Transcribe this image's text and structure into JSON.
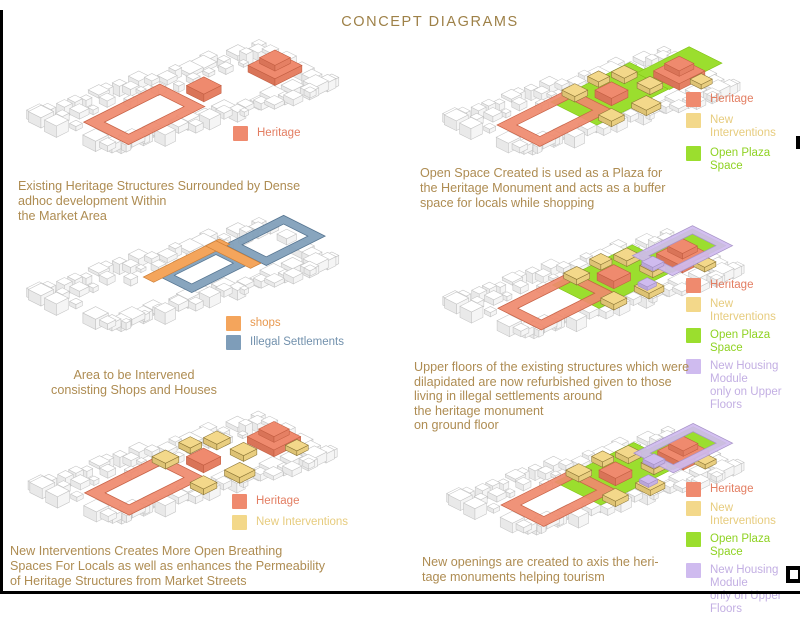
{
  "title": "CONCEPT DIAGRAMS",
  "colors": {
    "heritage": "#EF8A6E",
    "new_interventions": "#F3D88A",
    "open_plaza_space": "#9BDE2E",
    "new_housing_module": "#CFBBEF",
    "shops": "#F4A55C",
    "illegal_settlements": "#7E9DB9",
    "caption_text": "#AE8C52"
  },
  "panels": [
    {
      "id": "existing-heritage",
      "caption": [
        "Existing Heritage Structures Surrounded by Dense",
        "adhoc development Within",
        "the Market Area"
      ],
      "legend": [
        {
          "label": "Heritage",
          "key": "heritage"
        }
      ]
    },
    {
      "id": "area-intervened",
      "caption": [
        "Area to be Intervened",
        "consisting Shops and Houses"
      ],
      "legend": [
        {
          "label": "shops",
          "key": "shops"
        },
        {
          "label": "Illegal Settlements",
          "key": "illegal_settlements"
        }
      ]
    },
    {
      "id": "new-interventions",
      "caption": [
        "New Interventions Creates More Open Breathing",
        "Spaces For Locals as well as enhances the Permeability",
        "of Heritage Structures from Market Streets"
      ],
      "legend": [
        {
          "label": "Heritage",
          "key": "heritage"
        },
        {
          "label": "New Interventions",
          "key": "new_interventions"
        }
      ]
    },
    {
      "id": "open-space-plaza",
      "caption": [
        "Open Space Created is used as a Plaza for",
        "the Heritage Monument and acts as a buffer",
        "space for locals while shopping"
      ],
      "legend": [
        {
          "label": "Heritage",
          "key": "heritage"
        },
        {
          "label": "New Interventions",
          "key": "new_interventions"
        },
        {
          "label": "Open Plaza Space",
          "key": "open_plaza_space"
        }
      ]
    },
    {
      "id": "upper-floors",
      "caption": [
        "Upper floors of the existing structures which were",
        "dilapidated are now refurbished given to those",
        "living in illegal settlements around",
        " the heritage monument",
        " on ground floor"
      ],
      "legend": [
        {
          "label": "Heritage",
          "key": "heritage"
        },
        {
          "label": "New Interventions",
          "key": "new_interventions"
        },
        {
          "label": "Open Plaza Space",
          "key": "open_plaza_space"
        },
        {
          "label": "New Housing Module\nonly on Upper Floors",
          "key": "new_housing_module"
        }
      ]
    },
    {
      "id": "new-openings",
      "caption": [
        "New openings are created to axis the heri-",
        "tage monuments helping tourism"
      ],
      "legend": [
        {
          "label": "Heritage",
          "key": "heritage"
        },
        {
          "label": "New Interventions",
          "key": "new_interventions"
        },
        {
          "label": "Open Plaza Space",
          "key": "open_plaza_space"
        },
        {
          "label": "New Housing Module\nonly on Upper Floors",
          "key": "new_housing_module"
        }
      ]
    }
  ]
}
